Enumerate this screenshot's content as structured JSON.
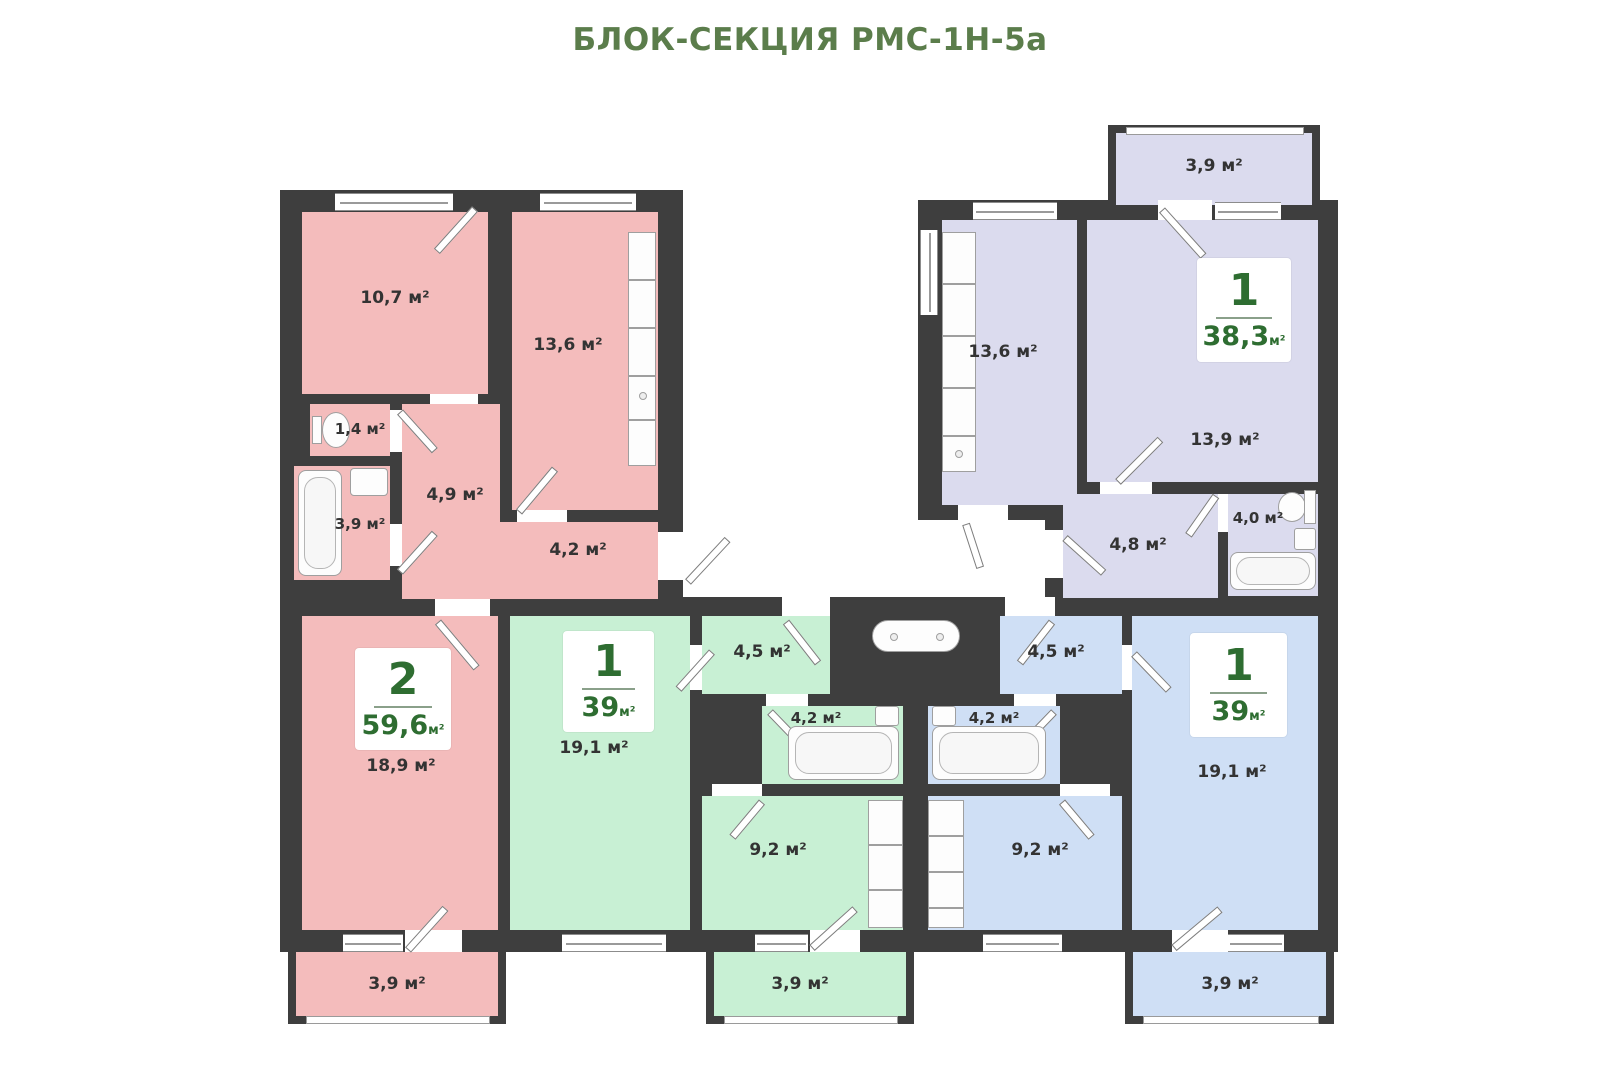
{
  "title": "БЛОК-СЕКЦИЯ РМС-1Н-5а",
  "colors": {
    "wall": "#3e3e3e",
    "title_green": "#5b7d4b",
    "card_green": "#2e6d31",
    "apt_pink": "#f4bcbc",
    "apt_green": "#c8f0d4",
    "apt_blue": "#cfdff5",
    "apt_lavender": "#dbdbee"
  },
  "apartments": [
    {
      "name": "2-комнатная квартира",
      "color": "#f4bcbc",
      "card": {
        "rooms": "2",
        "area": "59,6",
        "unit": "м²"
      },
      "rooms": [
        {
          "name": "bedroom",
          "label": "10,7 м²"
        },
        {
          "name": "kitchen",
          "label": "13,6 м²"
        },
        {
          "name": "wc",
          "label": "1,4 м²"
        },
        {
          "name": "bathroom",
          "label": "3,9 м²"
        },
        {
          "name": "hallway",
          "label": "4,9 м²"
        },
        {
          "name": "corridor",
          "label": "4,2 м²"
        },
        {
          "name": "living",
          "label": "18,9 м²"
        },
        {
          "name": "balcony",
          "label": "3,9 м²"
        }
      ]
    },
    {
      "name": "1-комнатная квартира (зелёная)",
      "color": "#c8f0d4",
      "card": {
        "rooms": "1",
        "area": "39",
        "unit": "м²"
      },
      "rooms": [
        {
          "name": "living",
          "label": "19,1 м²"
        },
        {
          "name": "hallway",
          "label": "4,5 м²"
        },
        {
          "name": "bathroom",
          "label": "4,2 м²"
        },
        {
          "name": "kitchen",
          "label": "9,2 м²"
        },
        {
          "name": "balcony",
          "label": "3,9 м²"
        }
      ]
    },
    {
      "name": "1-комнатная квартира (голубая)",
      "color": "#cfdff5",
      "card": {
        "rooms": "1",
        "area": "39",
        "unit": "м²"
      },
      "rooms": [
        {
          "name": "hallway",
          "label": "4,5 м²"
        },
        {
          "name": "bathroom",
          "label": "4,2 м²"
        },
        {
          "name": "kitchen",
          "label": "9,2 м²"
        },
        {
          "name": "living",
          "label": "19,1 м²"
        },
        {
          "name": "balcony",
          "label": "3,9 м²"
        }
      ]
    },
    {
      "name": "1-комнатная квартира (лавандовая)",
      "color": "#dbdbee",
      "card": {
        "rooms": "1",
        "area": "38,3",
        "unit": "м²"
      },
      "rooms": [
        {
          "name": "kitchen",
          "label": "13,6 м²"
        },
        {
          "name": "living",
          "label": "13,9 м²"
        },
        {
          "name": "hallway",
          "label": "4,8 м²"
        },
        {
          "name": "bathroom",
          "label": "4,0 м²"
        },
        {
          "name": "balcony",
          "label": "3,9 м²"
        }
      ]
    }
  ]
}
